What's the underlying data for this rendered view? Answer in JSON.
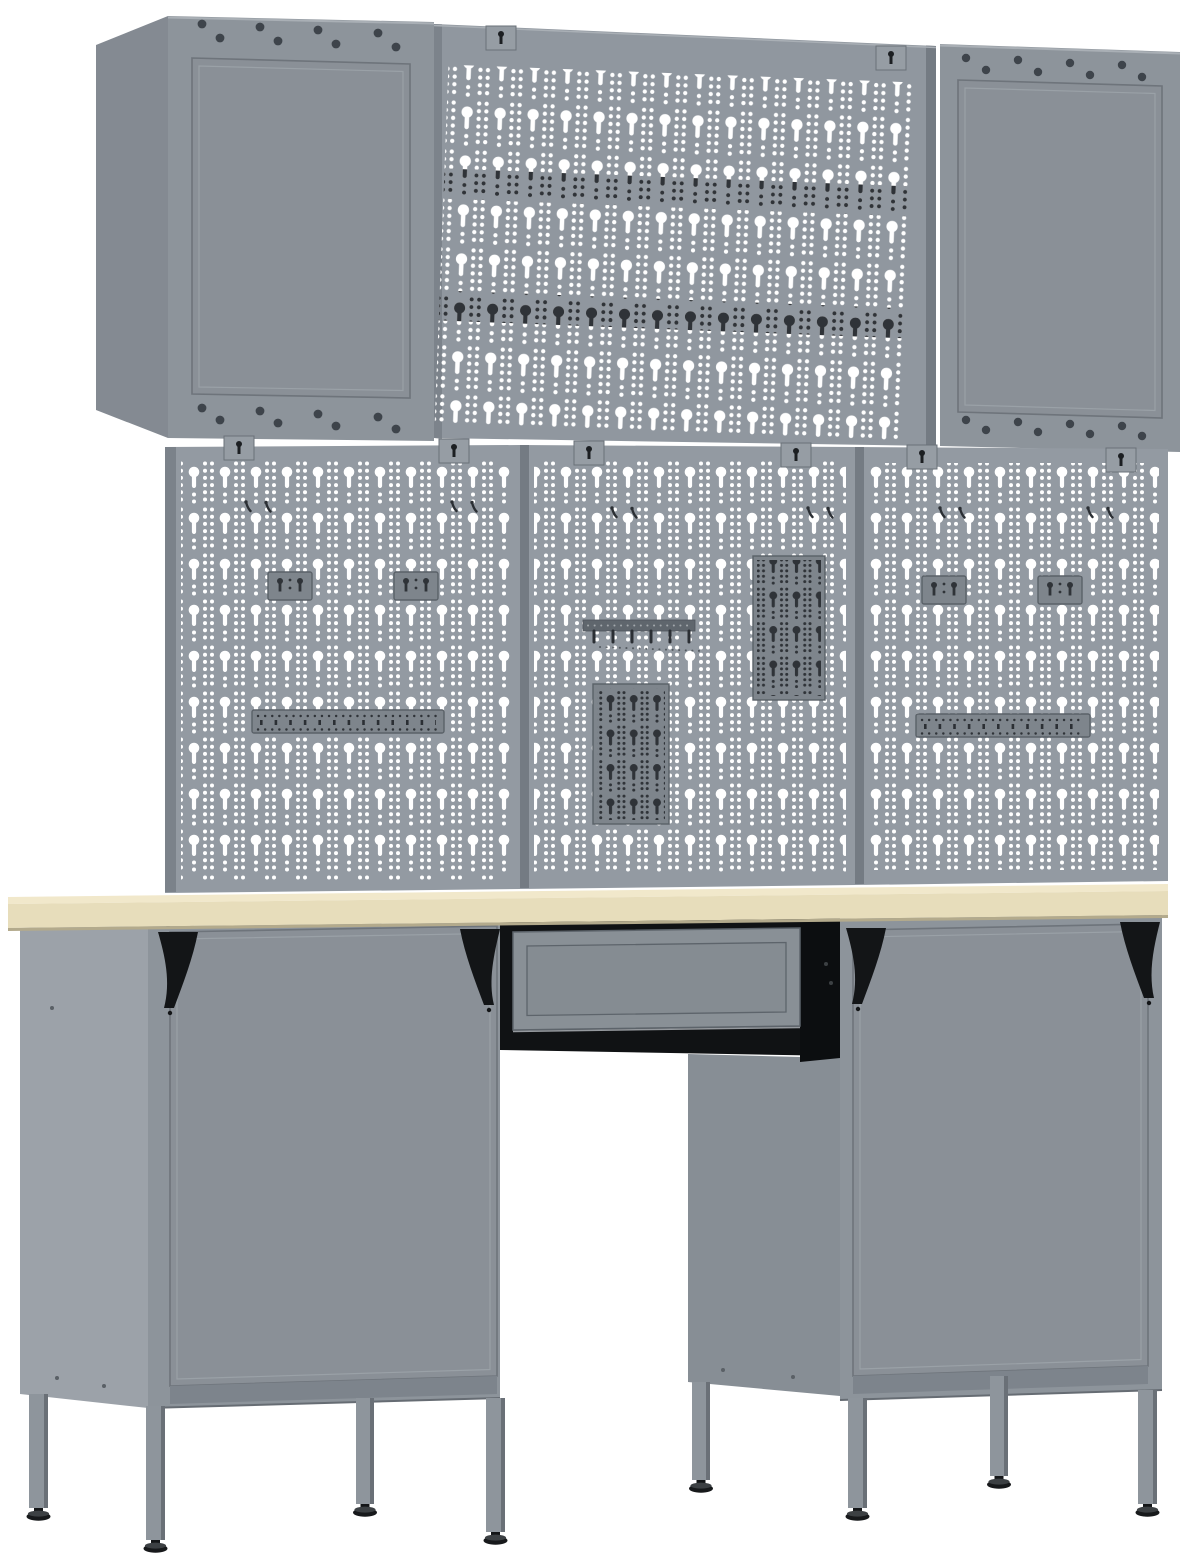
{
  "scene": {
    "type": "product-render",
    "subject": "grey metal garage workbench set: two wall cabinets and a perforated wall panel on top, three pegboard panels with hook strips and holder plates, light wooden worktop, two base cabinets on adjustable legs with a centre drawer",
    "background": "#ffffff"
  },
  "colors": {
    "bg": "#ffffff",
    "cab_front": "#8d949b",
    "cab_side": "#848a92",
    "side_light": "#9ca2a9",
    "side_shadow": "#878e95",
    "door": "#8a9097",
    "door_stroke": "#6e747b",
    "door_light": "#a8aeb4",
    "door_kick": "#7d848c",
    "edge_light": "#a9afb5",
    "bottom_line": "#666c73",
    "panel": "#90979f",
    "pegboard": "#939aa2",
    "seam": "#747b83",
    "peg_edge": "#7b828a",
    "hole_white": "#ffffff",
    "hole_dark": "#2f3338",
    "plate": "#7e858c",
    "plate_stroke": "#5a6168",
    "accessory": "#2b2f34",
    "bar": "#5f666d",
    "tab": "#969da4",
    "tab_stroke": "#6a7178",
    "slot": "#1c1f22",
    "rivet": "#3e444b",
    "worktop_top": "#f1e8cb",
    "worktop_front": "#e7ddbb",
    "worktop_shadow": "#b3aa8c",
    "housing": "#101214",
    "housing_dark": "#0c0e10",
    "drawer_face": "#899096",
    "drawer_inner": "#858c92",
    "drawer_stroke": "#5d646b",
    "drawer_light": "#c2c7cc",
    "leg": "#8e959c",
    "leg_shade": "#6a7077",
    "black": "#131517",
    "foot": "#17191b",
    "foot_top": "#3c4043",
    "screw": "#5a6066"
  },
  "inventory": {
    "wall_cabinets": 2,
    "wall_pegboard_panels": 1,
    "pegboard_panels": 3,
    "mounting_tabs": 8,
    "two_peg_hangers": 4,
    "tool_holder_strips": 2,
    "holder_plates": 2,
    "rail_holders": 1,
    "small_hook_pairs": 6,
    "worktops": 1,
    "base_cabinets": 2,
    "drawers": 1,
    "corner_braces": 4,
    "legs": 8,
    "adjustable_feet": 8
  }
}
